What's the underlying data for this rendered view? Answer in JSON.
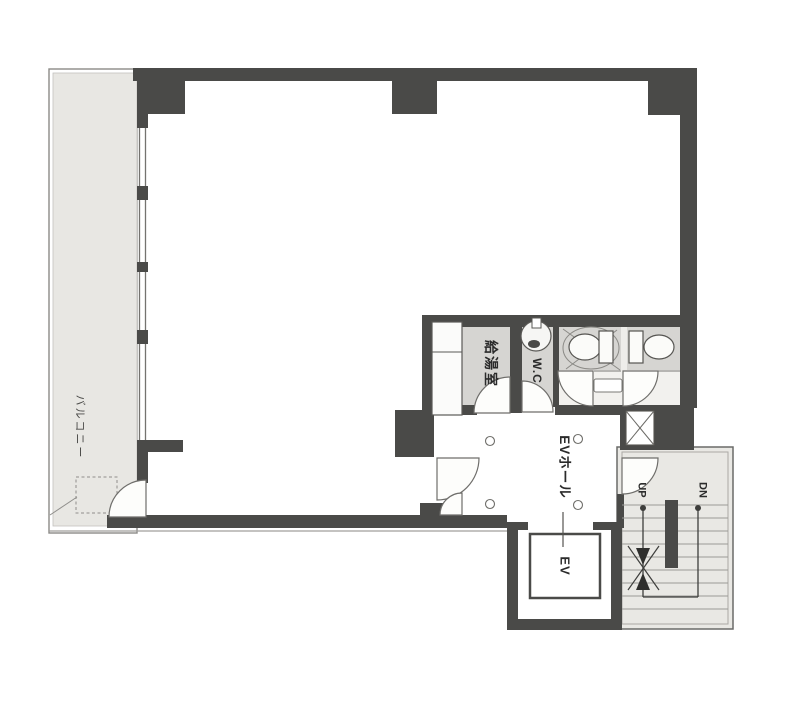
{
  "plan": {
    "type": "office-floor-plan",
    "labels": {
      "balcony": "バルコニー",
      "kitchenette": "給湯室",
      "toilet": "W.C",
      "elevator_hall": "EVホール",
      "elevator": "EV",
      "stairs_up": "UP",
      "stairs_down": "DN"
    },
    "colors": {
      "wall": "#4a4a48",
      "balcony_floor": "#e8e7e3",
      "wet_area_floor": "#d6d5d2",
      "corridor_floor": "#f2f1ee",
      "stair_floor": "#e9e8e4",
      "fixture_fill": "#fbfbfa",
      "line": "#6f6e6b",
      "text": "#2b2b2b",
      "background": "#ffffff"
    }
  }
}
